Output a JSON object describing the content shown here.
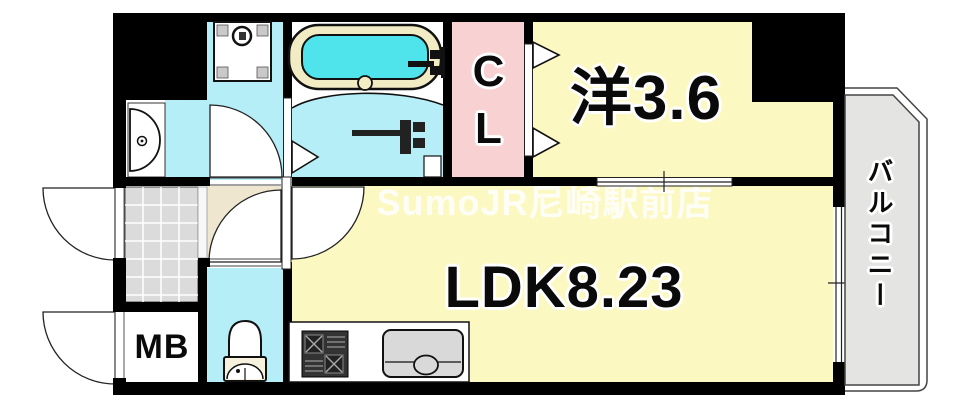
{
  "floorplan": {
    "rooms": {
      "western_room": {
        "label": "洋3.6"
      },
      "ldk": {
        "label": "LDK8.23"
      },
      "closet": {
        "label": "CL"
      },
      "meter_box": {
        "label": "MB"
      },
      "balcony": {
        "label": "バルコニー"
      }
    },
    "watermark": "SumoJR尼崎駅前店",
    "colors": {
      "wall": "#000000",
      "room_yellow": "#FCF8C2",
      "wet_area_cyan": "#B5EEF6",
      "bathtub_water": "#4FE3EC",
      "bathtub_rim": "#F2ECC5",
      "closet_pink": "#F8D2D2",
      "hallway_beige": "#EFE6CF",
      "entrance_tile_gray": "#DBDBDB",
      "balcony_gray": "#E4E4E3",
      "fixture_gray": "#D9D9D9"
    },
    "fixtures": [
      "bathtub",
      "washing-machine-pan",
      "washbasin",
      "toilet",
      "gas-stove",
      "kitchen-sink"
    ]
  }
}
